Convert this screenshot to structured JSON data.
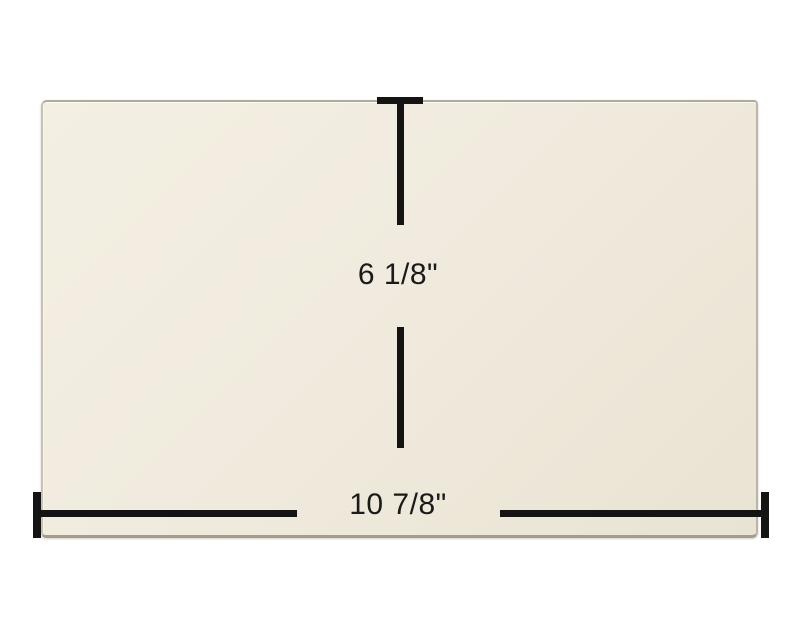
{
  "diagram": {
    "title": "glass panel dimension diagram",
    "height_dimension": {
      "label": "6 1/8\""
    },
    "width_dimension": {
      "label": "10 7/8\""
    }
  },
  "colors": {
    "background": "#ffffff",
    "panel_fill": "#f0ebde",
    "panel_edge": "#b2aa99",
    "dimension_line": "#141414",
    "label_text": "#1a1a1a"
  }
}
